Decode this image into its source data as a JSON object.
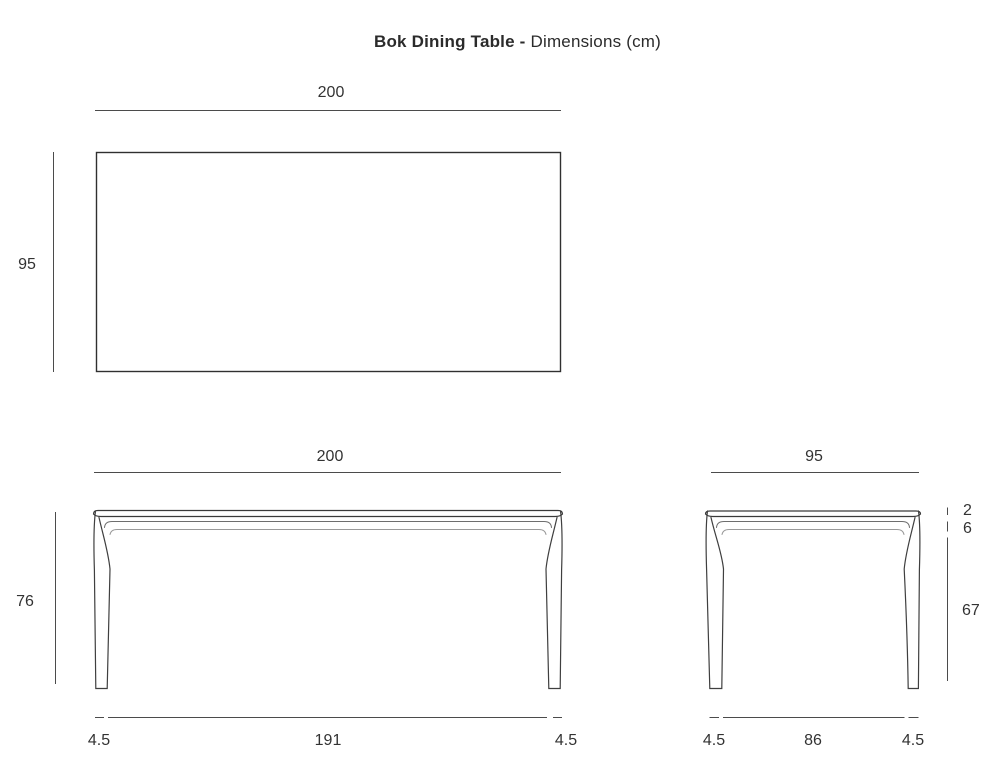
{
  "title": {
    "product": "Bok Dining Table -",
    "subtitle": "Dimensions (cm)"
  },
  "units": "cm",
  "colors": {
    "background": "#ffffff",
    "drawing_line": "#3a3a3a",
    "dimension_line": "#4b4b4b",
    "text": "#333333"
  },
  "views": {
    "top": {
      "width": "200",
      "depth": "95"
    },
    "front": {
      "width": "200",
      "height": "76",
      "leg_left": "4.5",
      "inner_span": "191",
      "leg_right": "4.5"
    },
    "side": {
      "width": "95",
      "top_thickness": "2",
      "apron_depth": "6",
      "leg_height": "67",
      "leg_left": "4.5",
      "inner_span": "86",
      "leg_right": "4.5"
    }
  }
}
